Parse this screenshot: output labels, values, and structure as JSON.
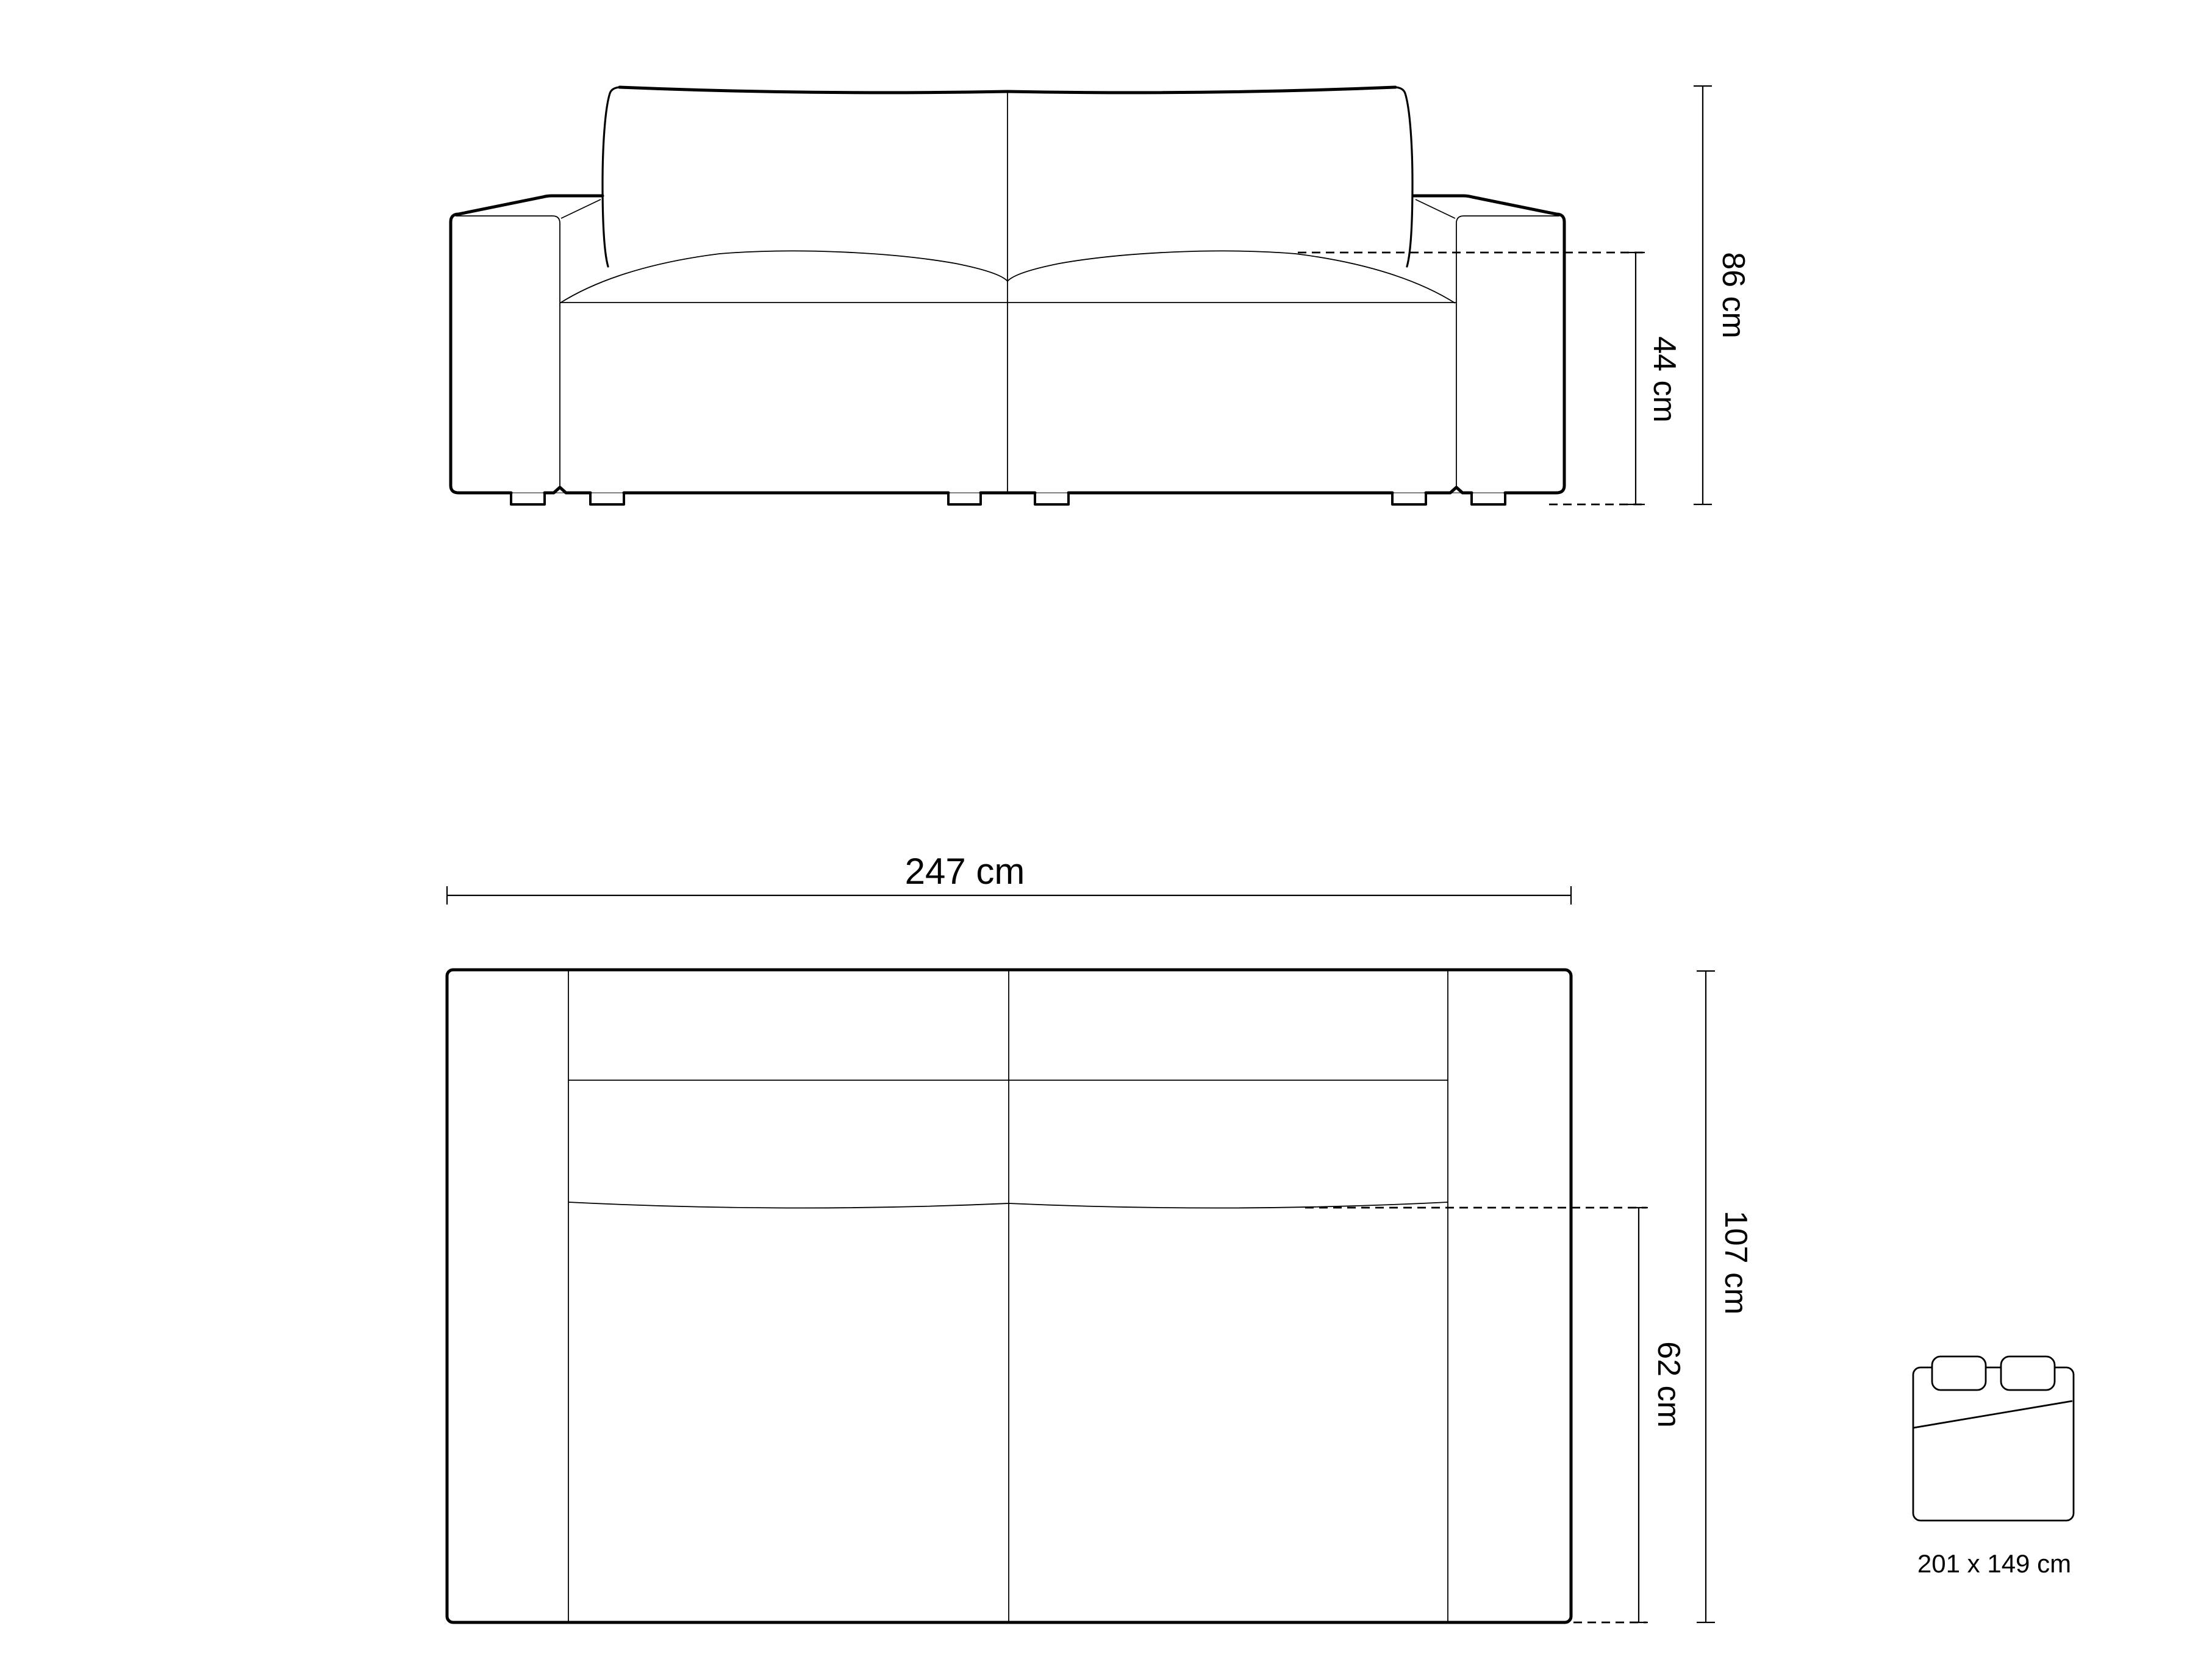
{
  "diagram": {
    "type": "sofa-dimension-drawing",
    "front_view": {
      "overall_height_label": "86 cm",
      "seat_height_label": "44 cm"
    },
    "top_view": {
      "overall_width_label": "247 cm",
      "overall_depth_label": "107 cm",
      "seat_depth_label": "62 cm"
    },
    "sleeping_area": {
      "size_label": "201 x 149 cm"
    },
    "colors": {
      "line": "#000000",
      "background": "#ffffff"
    }
  }
}
